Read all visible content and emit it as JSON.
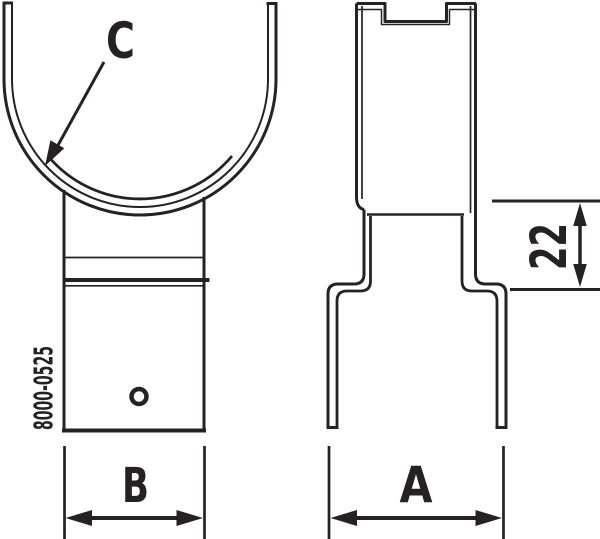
{
  "diagram": {
    "part_number": "8000-0525",
    "labels": {
      "c": "C",
      "b": "B",
      "a": "A",
      "dim22": "22"
    },
    "colors": {
      "line": "#262223",
      "background": "#ffffff"
    }
  }
}
